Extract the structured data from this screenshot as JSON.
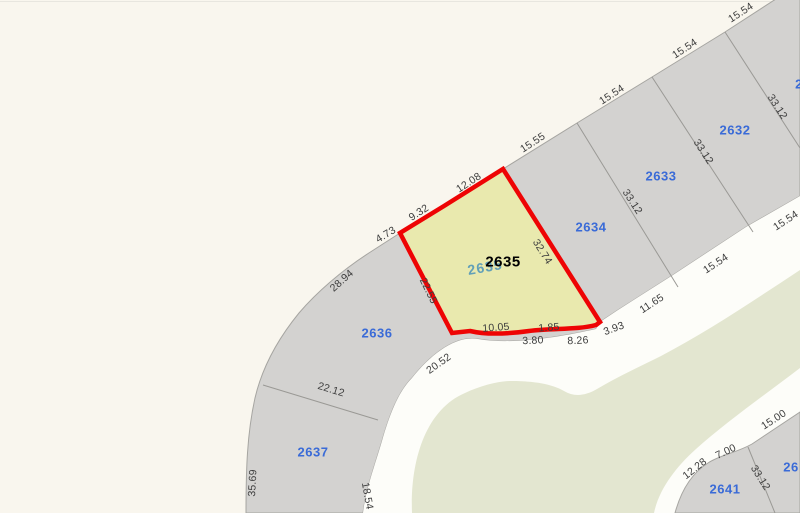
{
  "map": {
    "selected_parcel_id": "2635",
    "colors": {
      "bg": "#f9f6ee",
      "parcel-gray": "#d3d2d0",
      "parcel-stroke": "#a6a5a1",
      "boundary": "#9a9995",
      "road": "#fdfdf9",
      "green": "#e3e6d0",
      "highlight-fill": "#e9e9ae",
      "highlight-stroke": "#ee0404",
      "parcel-blue": "#3a6bd7",
      "dim-text": "#3d3d3d",
      "teal": "#62a0b8",
      "selected-black": "#000000"
    },
    "labels": [
      {
        "kind": "dim",
        "text": "15.54",
        "x": 741,
        "y": 13,
        "rot": -33
      },
      {
        "kind": "dim",
        "text": "15.54",
        "x": 685,
        "y": 49,
        "rot": -33
      },
      {
        "kind": "dim",
        "text": "15.54",
        "x": 612,
        "y": 95,
        "rot": -33
      },
      {
        "kind": "dim",
        "text": "15.55",
        "x": 533,
        "y": 143,
        "rot": -33
      },
      {
        "kind": "dim",
        "text": "12.08",
        "x": 469,
        "y": 183,
        "rot": -33
      },
      {
        "kind": "dim",
        "text": "9.32",
        "x": 419,
        "y": 213,
        "rot": -33
      },
      {
        "kind": "dim",
        "text": "4.73",
        "x": 386,
        "y": 235,
        "rot": -31
      },
      {
        "kind": "dim",
        "text": "28.94",
        "x": 342,
        "y": 281,
        "rot": -42
      },
      {
        "kind": "dim",
        "text": "22.12",
        "x": 331,
        "y": 390,
        "rot": 17
      },
      {
        "kind": "dim",
        "text": "35.69",
        "x": 253,
        "y": 483,
        "rot": -87
      },
      {
        "kind": "dim",
        "text": "18.54",
        "x": 367,
        "y": 496,
        "rot": 80
      },
      {
        "kind": "dim",
        "text": "20.52",
        "x": 439,
        "y": 364,
        "rot": -35
      },
      {
        "kind": "dim",
        "text": "22.55",
        "x": 428,
        "y": 291,
        "rot": 64
      },
      {
        "kind": "dim",
        "text": "32.74",
        "x": 542,
        "y": 252,
        "rot": 58
      },
      {
        "kind": "dim",
        "text": "10.05",
        "x": 496,
        "y": 328,
        "rot": -4
      },
      {
        "kind": "dim",
        "text": "1.85",
        "x": 549,
        "y": 328,
        "rot": -4
      },
      {
        "kind": "dim",
        "text": "3.80",
        "x": 533,
        "y": 341,
        "rot": -3
      },
      {
        "kind": "dim",
        "text": "8.26",
        "x": 578,
        "y": 341,
        "rot": -3
      },
      {
        "kind": "dim",
        "text": "3.93",
        "x": 614,
        "y": 329,
        "rot": -20
      },
      {
        "kind": "dim",
        "text": "11.65",
        "x": 652,
        "y": 304,
        "rot": -33
      },
      {
        "kind": "dim",
        "text": "15.54",
        "x": 716,
        "y": 264,
        "rot": -33
      },
      {
        "kind": "dim",
        "text": "15.54",
        "x": 786,
        "y": 221,
        "rot": -33
      },
      {
        "kind": "dim",
        "text": "33.12",
        "x": 777,
        "y": 107,
        "rot": 57
      },
      {
        "kind": "dim",
        "text": "33.12",
        "x": 703,
        "y": 152,
        "rot": 57
      },
      {
        "kind": "dim",
        "text": "33.12",
        "x": 632,
        "y": 202,
        "rot": 57
      },
      {
        "kind": "dim",
        "text": "12.28",
        "x": 695,
        "y": 469,
        "rot": -38
      },
      {
        "kind": "dim",
        "text": "7.00",
        "x": 726,
        "y": 452,
        "rot": -25
      },
      {
        "kind": "dim",
        "text": "15.00",
        "x": 774,
        "y": 420,
        "rot": -33
      },
      {
        "kind": "dim",
        "text": "33.12",
        "x": 760,
        "y": 478,
        "rot": 58
      },
      {
        "kind": "parcel",
        "text": "2632",
        "x": 735,
        "y": 130,
        "rot": 0
      },
      {
        "kind": "parcel",
        "text": "2633",
        "x": 661,
        "y": 176,
        "rot": 0
      },
      {
        "kind": "parcel",
        "text": "2634",
        "x": 591,
        "y": 227,
        "rot": 0
      },
      {
        "kind": "parcel",
        "text": "2636",
        "x": 377,
        "y": 333,
        "rot": 0
      },
      {
        "kind": "parcel",
        "text": "2637",
        "x": 313,
        "y": 452,
        "rot": 0
      },
      {
        "kind": "parcel",
        "text": "2641",
        "x": 725,
        "y": 489,
        "rot": 0
      },
      {
        "kind": "parcel",
        "text": "2",
        "x": 799,
        "y": 84,
        "rot": 0
      },
      {
        "kind": "parcel",
        "text": "26",
        "x": 791,
        "y": 467,
        "rot": 0
      },
      {
        "kind": "sel-sub",
        "text": "2635",
        "x": 485,
        "y": 267,
        "rot": -10
      },
      {
        "kind": "sel-main",
        "text": "2635",
        "x": 503,
        "y": 262,
        "rot": 0
      }
    ]
  }
}
